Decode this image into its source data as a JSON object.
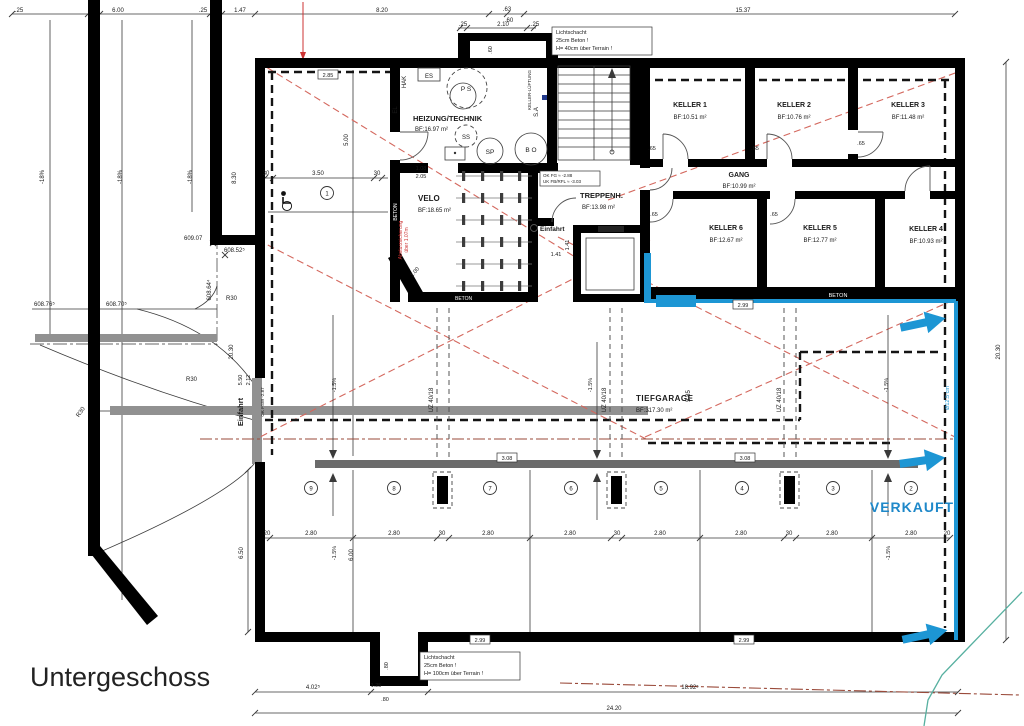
{
  "title": "Untergeschoss",
  "rooms": {
    "heizung": {
      "name": "HEIZUNG/TECHNIK",
      "area": "BF:16.97 m²"
    },
    "velo": {
      "name": "VELO",
      "area": "BF:18.65 m²"
    },
    "treppenhaus": {
      "name": "TREPPENH.",
      "area": "BF:13.98 m²"
    },
    "gang": {
      "name": "GANG",
      "area": "BF:10.99 m²"
    },
    "keller1": {
      "name": "KELLER 1",
      "area": "BF:10.51 m²"
    },
    "keller2": {
      "name": "KELLER 2",
      "area": "BF:10.76 m²"
    },
    "keller3": {
      "name": "KELLER 3",
      "area": "BF:11.48 m²"
    },
    "keller4": {
      "name": "KELLER 4",
      "area": "BF:10.93 m²"
    },
    "keller5": {
      "name": "KELLER 5",
      "area": "BF:12.77 m²"
    },
    "keller6": {
      "name": "KELLER 6",
      "area": "BF:12.67 m²"
    },
    "tiefgarage": {
      "name": "TIEFGARAGE",
      "area": "BF:317.30 m²"
    }
  },
  "parking": {
    "s1": "1",
    "s2": "2",
    "s3": "3",
    "s4": "4",
    "s5": "5",
    "s6": "6",
    "s7": "7",
    "s8": "8",
    "s9": "9",
    "verkauft": "VERKAUFT"
  },
  "equipment": {
    "ps": "P S",
    "ss": "SS",
    "sp": "SP",
    "bo": "B O",
    "es": "ES",
    "el": "EL",
    "hak": "HAK",
    "sa": "S.A",
    "lueftung": "KELLER-LÜFTUNG"
  },
  "annotations": {
    "lichtschacht_top": {
      "l1": "Lichtschacht",
      "l2": "25cm Beton !",
      "l3": "H= 40cm über Terrain !"
    },
    "lichtschacht_bottom": {
      "l1": "Lichtschacht",
      "l2": "25cm Beton !",
      "l3": "H= 100cm über Terrain !"
    },
    "levelbox": {
      "l1": "OK FG ≈ -2.88",
      "l2": "UK FB/RFL ≈ -3.03"
    },
    "beton": "BETON",
    "einfahrt_hall": "Einfahrt",
    "einfahrt_ramp": "Einfahrt",
    "okfsw": "OK FSW -2.87",
    "absturz1": "Absturzsicherung",
    "absturz2": "über 1.07m",
    "pipe_note": "Ø12.5 cm",
    "uz": "UZ 40/18",
    "slope_ramp": "-18%",
    "slope_garage": "-1.5%",
    "r30": "R30"
  },
  "levels": {
    "p1": "609.07",
    "p2": "608.52⁵",
    "p3": "608.64⁴",
    "p4": "608.76⁵",
    "p5": "608.70⁵"
  },
  "dims": {
    "d25": ".25",
    "d600": "6.00",
    "d147": "1.47",
    "d820": "8.20",
    "d63": ".63",
    "d60": ".60",
    "d210": "2.10",
    "d1537": "15.37",
    "d830": "8.30",
    "d350": "3.50",
    "d30": "30",
    "d285": "2.85",
    "d500": "5.00",
    "d2030": "20.30",
    "d550": "5.50",
    "d212": "2.12",
    "d650": "6.50",
    "d108": "1.08",
    "d205": "2.05",
    "d141": "1.41",
    "d100": "1.00",
    "d65": ".65",
    "d585": "5.85",
    "d280": "2.80",
    "d20": "20",
    "d299": "2.99",
    "d308": "3.08",
    "d4025": "4.02⁵",
    "d125": "1.25",
    "d80": ".80",
    "d18925": "18.92⁵",
    "d2420": "24.20"
  },
  "colors": {
    "blue": "#1d96d4",
    "verkauft": "#1e88c9",
    "red_dash": "#d4685e",
    "property_line": "#9a4a3a",
    "teal": "#57b0a0",
    "wall": "#000000",
    "gray_band": "#919191"
  }
}
